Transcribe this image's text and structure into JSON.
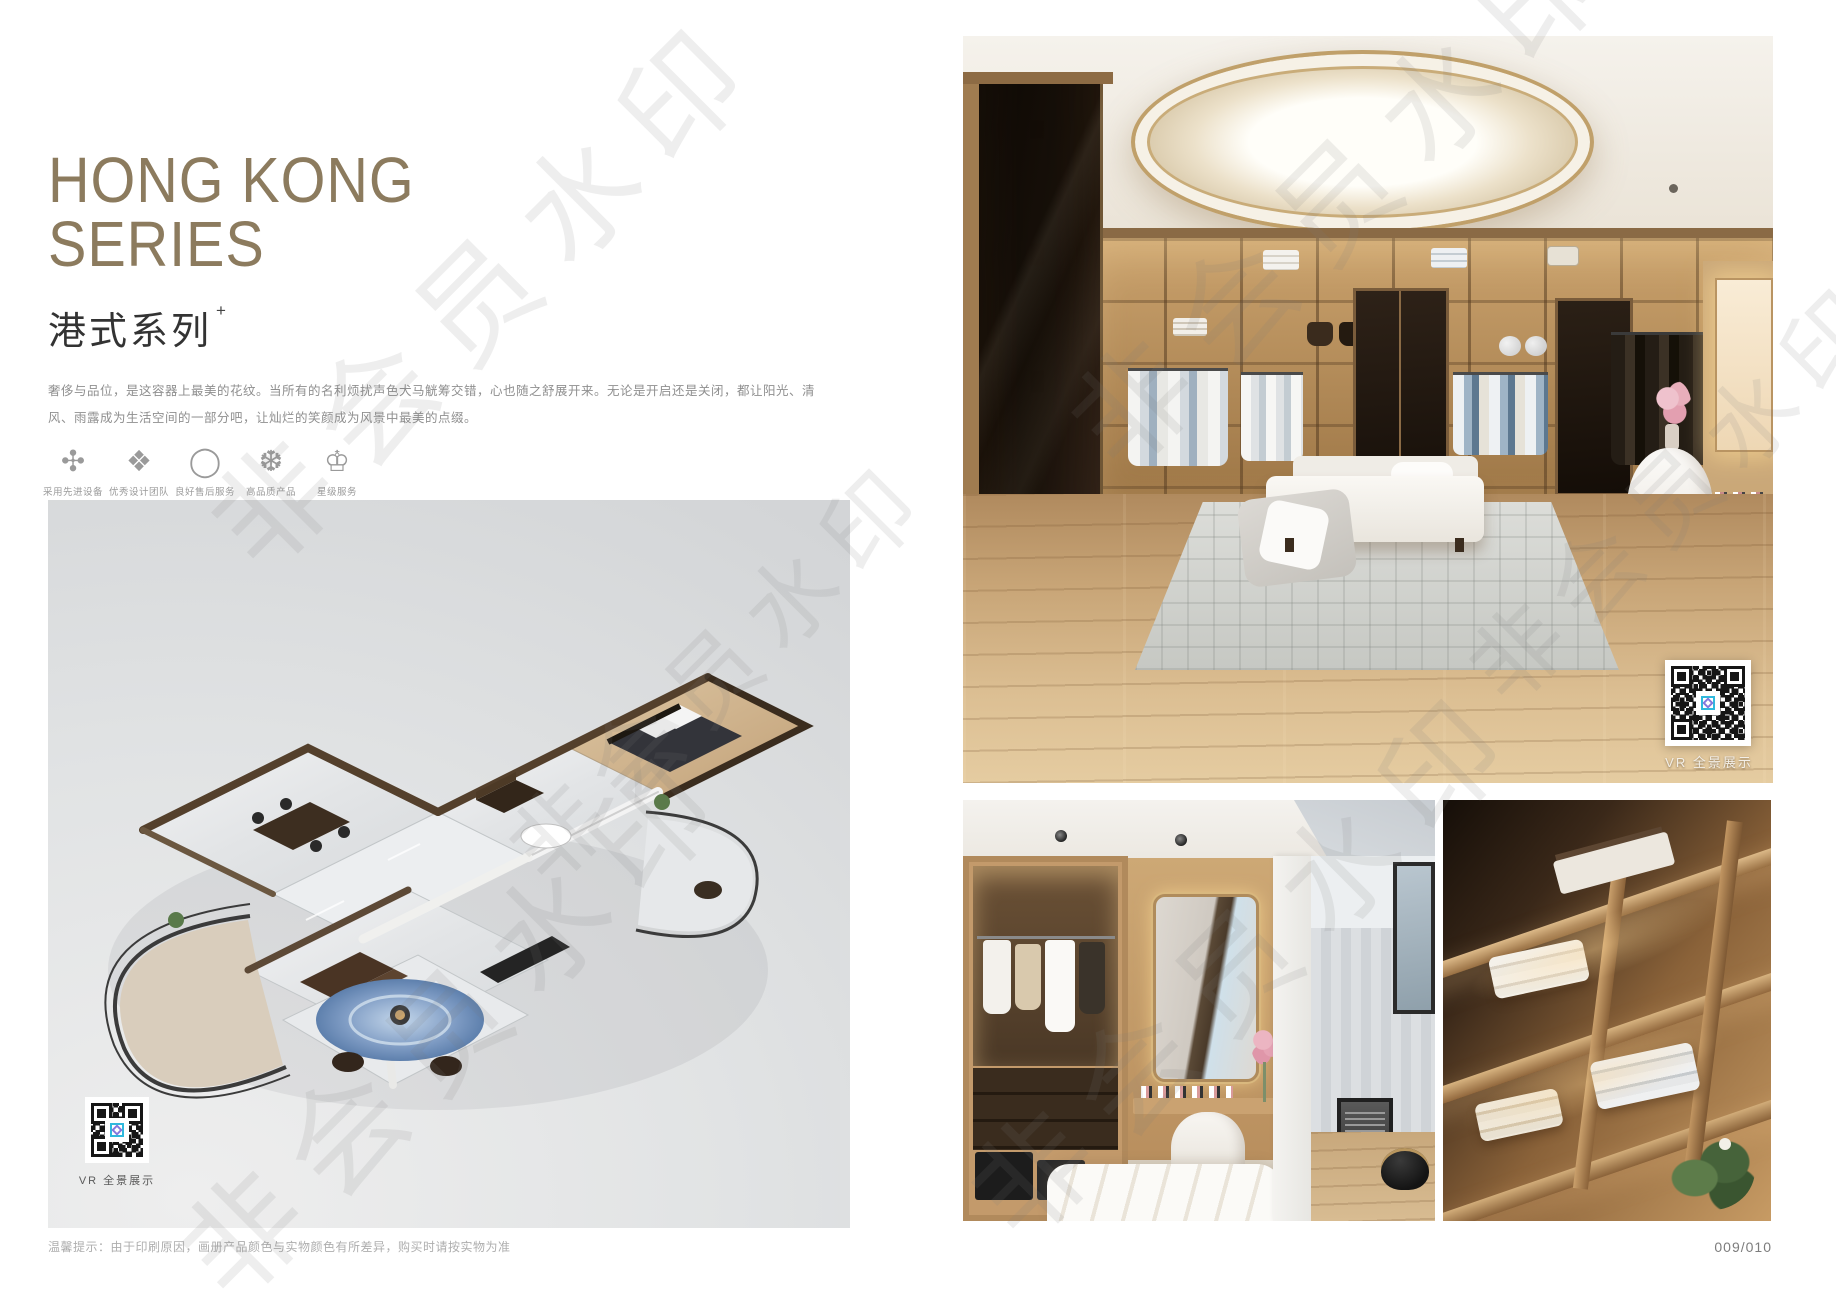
{
  "watermark": {
    "text": "非会员水印"
  },
  "left_page": {
    "title_line1": "HONG KONG",
    "title_line2": "SERIES",
    "subtitle": "港式系列",
    "subtitle_superscript": "+",
    "description_line1": "奢侈与品位，是这容器上最美的花纹。当所有的名利烦扰声色犬马觥筹交错，心也随之舒展开来。无论是开启还是关闭，都让阳光、清",
    "description_line2": "风、雨露成为生活空间的一部分吧，让灿烂的笑颜成为风景中最美的点缀。",
    "features": [
      {
        "glyph": "✣",
        "label": "采用先进设备"
      },
      {
        "glyph": "❖",
        "label": "优秀设计团队"
      },
      {
        "glyph": "◯",
        "label": "良好售后服务"
      },
      {
        "glyph": "❆",
        "label": "高品质产品"
      },
      {
        "glyph": "♔",
        "label": "星级服务"
      }
    ],
    "floorplan_qr_caption": "VR 全景展示"
  },
  "right_page": {
    "hero_qr_caption": "VR 全景展示"
  },
  "footer": {
    "disclaimer": "温馨提示：由于印刷原因，画册产品颜色与实物颜色有所差异，购买时请按实物为准",
    "page_number": "009/010"
  },
  "colors": {
    "title_accent": "#8c7b5e",
    "body_text": "#8f8f8f",
    "panel_gray": "#dfe1e2",
    "wood_warm": "#c8a577"
  }
}
